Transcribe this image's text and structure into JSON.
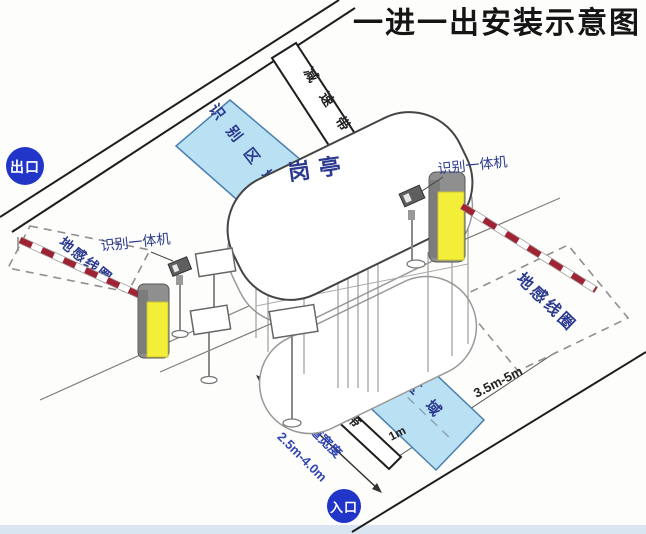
{
  "title": "一进一出安装示意图",
  "badges": {
    "exit": "出口",
    "entrance": "入口"
  },
  "booth": {
    "label": "岗亭"
  },
  "zones": {
    "recognition_top": "识别区域",
    "recognition_bottom": "识别区域"
  },
  "speed_bumps": {
    "top": "减速带",
    "bottom": "减速带"
  },
  "coils": {
    "left": "地感线圈",
    "right": "地感线圈"
  },
  "cameras": {
    "left_label": "识别一体机",
    "right_label": "识别一体机"
  },
  "measurements": {
    "coil_length": "3.5m-5m",
    "stop_line_offset": "1m",
    "lane_width_label": "车道宽度",
    "lane_width_value": "2.5m-4.0m"
  },
  "colors": {
    "badge_blue": "#2135c8",
    "zone_fill": "#b9e1f3",
    "zone_border": "#4a7fb0",
    "machine_yellow": "#f3ef39",
    "machine_gray": "#8f8f8f",
    "arm_red": "#9e2433",
    "label_navy": "#2b3a8f",
    "lane_text_blue": "#3246b4",
    "bottom_strip": "#d9e6f2",
    "title_color": "#151515"
  }
}
